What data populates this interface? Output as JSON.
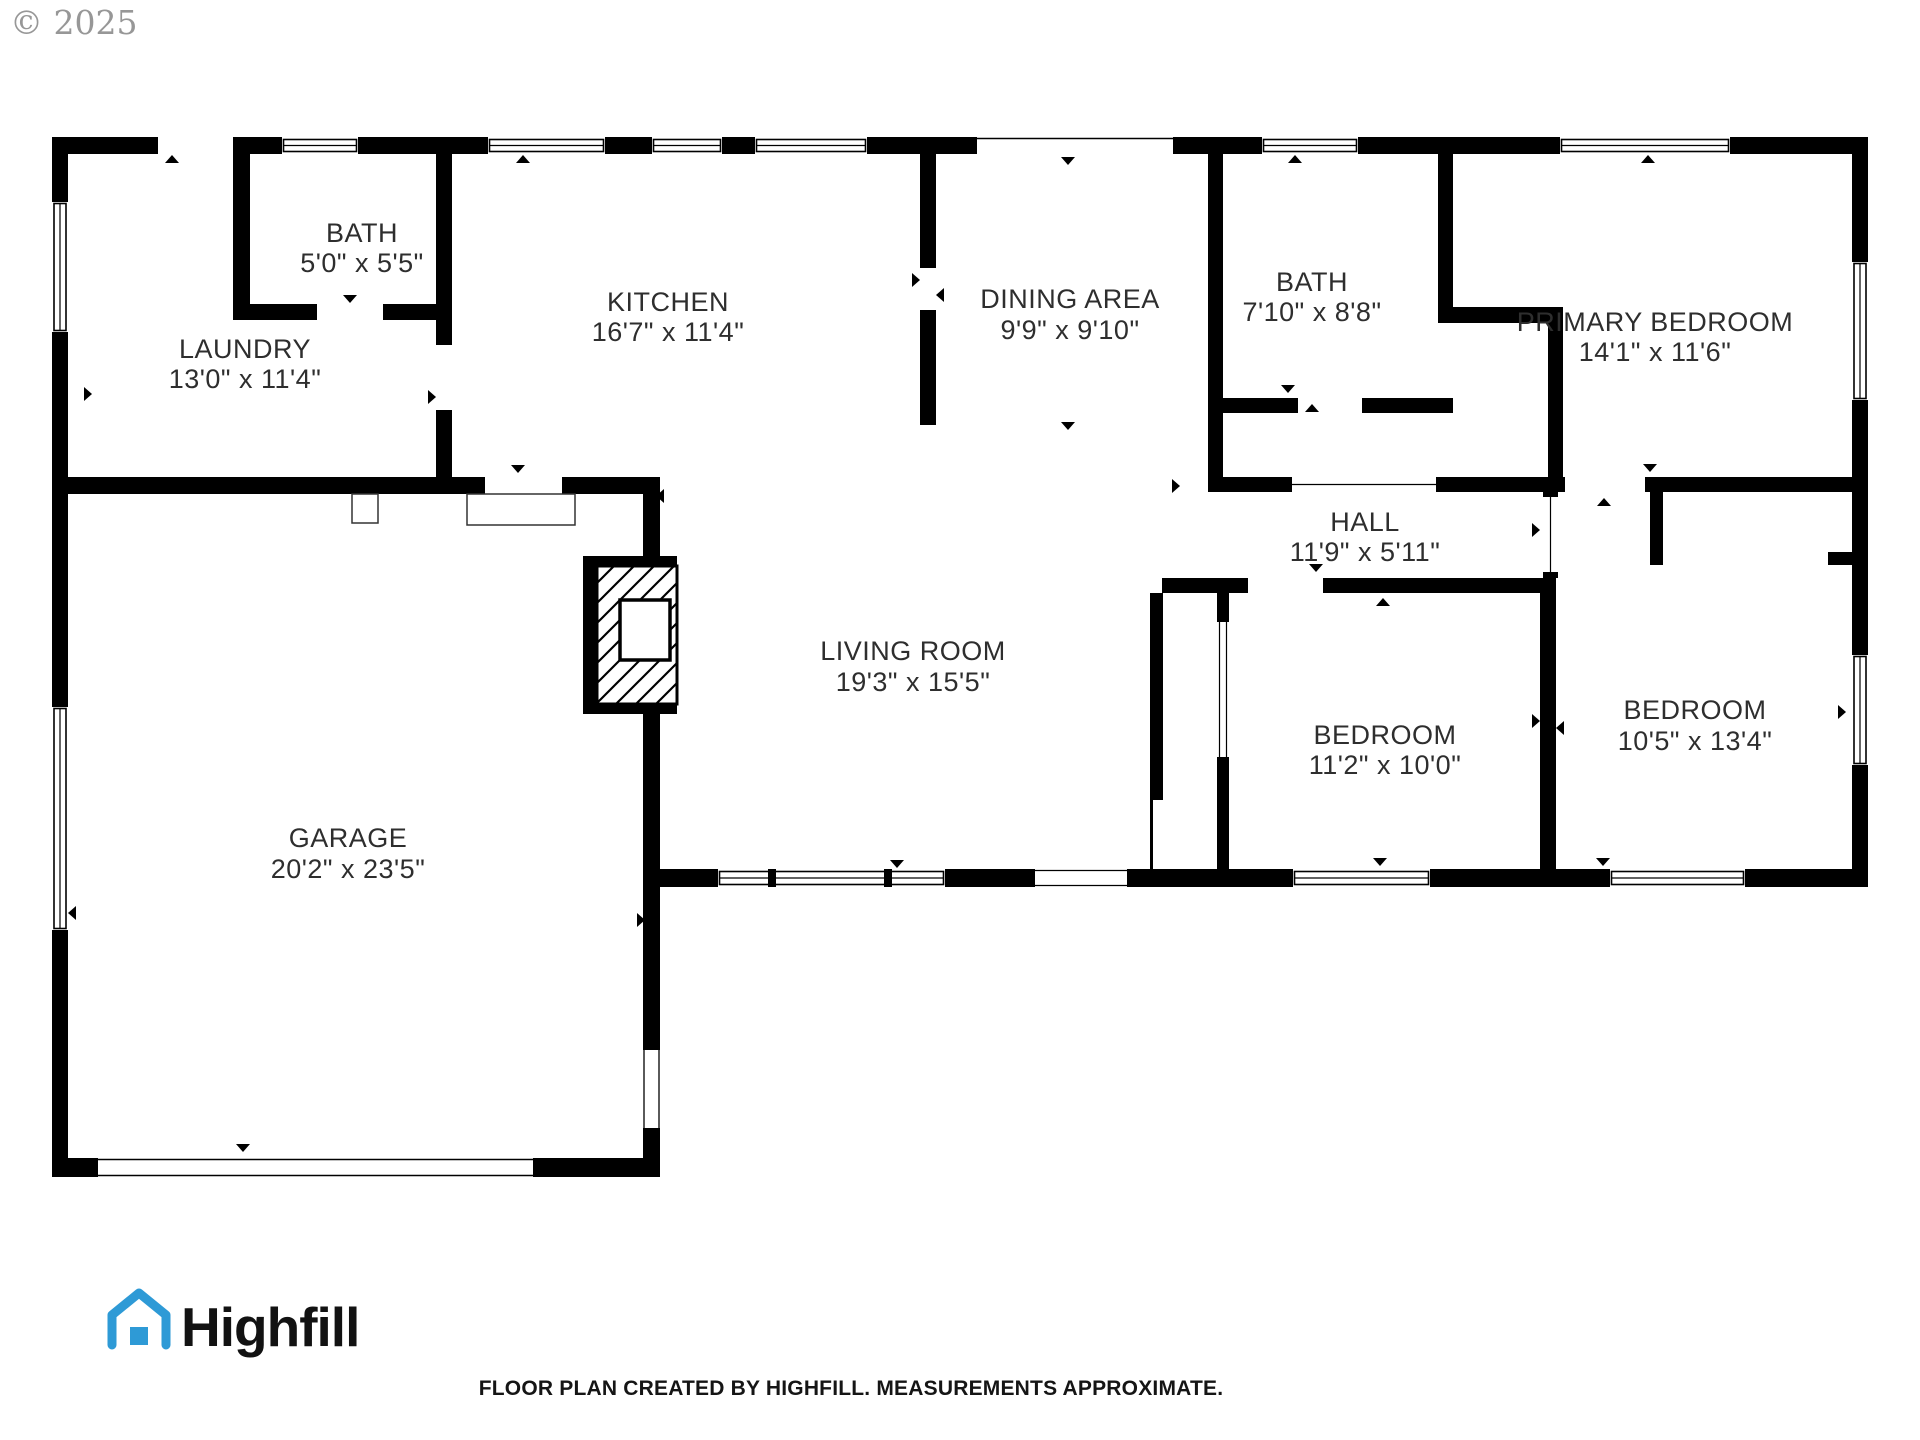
{
  "watermark": "© 2025",
  "rooms": [
    {
      "id": "bath-1",
      "name": "BATH",
      "dims": "5'0\" x 5'5\""
    },
    {
      "id": "laundry",
      "name": "LAUNDRY",
      "dims": "13'0\" x 11'4\""
    },
    {
      "id": "kitchen",
      "name": "KITCHEN",
      "dims": "16'7\" x 11'4\""
    },
    {
      "id": "dining-area",
      "name": "DINING AREA",
      "dims": "9'9\" x 9'10\""
    },
    {
      "id": "bath-2",
      "name": "BATH",
      "dims": "7'10\" x 8'8\""
    },
    {
      "id": "primary-bedroom",
      "name": "PRIMARY BEDROOM",
      "dims": "14'1\" x 11'6\""
    },
    {
      "id": "hall",
      "name": "HALL",
      "dims": "11'9\" x 5'11\""
    },
    {
      "id": "living-room",
      "name": "LIVING ROOM",
      "dims": "19'3\" x 15'5\""
    },
    {
      "id": "garage",
      "name": "GARAGE",
      "dims": "20'2\" x 23'5\""
    },
    {
      "id": "bedroom-1",
      "name": "BEDROOM",
      "dims": "11'2\" x 10'0\""
    },
    {
      "id": "bedroom-2",
      "name": "BEDROOM",
      "dims": "10'5\" x 13'4\""
    }
  ],
  "footer": {
    "brand": "Highfill",
    "disclaimer": "FLOOR PLAN CREATED BY HIGHFILL. MEASUREMENTS APPROXIMATE."
  },
  "colors": {
    "wall": "#000000",
    "label_text": "#2e2e2e",
    "brand_blue": "#2E9AD6",
    "brand_text": "#121212",
    "watermark_gray": "#979797"
  }
}
